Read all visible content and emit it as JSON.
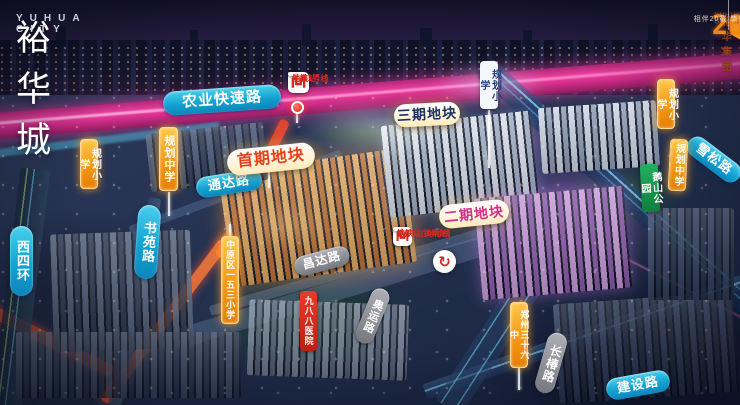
{
  "brand": {
    "name_cn": "裕华城",
    "name_en": "YUHUA CITY"
  },
  "group": {
    "name": "裕华集团",
    "name_en": "YUHUA GROUP",
    "anniversary_number": "20",
    "tagline": "相伴20载 筑就未来"
  },
  "metro": {
    "lanzhai": {
      "line1": "地铁1号线",
      "line2": "兰寨站"
    },
    "tielu": {
      "line1": "地铁1、14号线",
      "line2": "铁炉站(换乘站)"
    },
    "interchange_icon": "↻"
  },
  "map": {
    "labels": [
      {
        "name": "road-label-nongye-expressway",
        "cls": "lbl pill cyan",
        "text": "农业快速路",
        "x": 163,
        "y": 88,
        "w": 118,
        "h": 24,
        "rot": -4,
        "fs": 15
      },
      {
        "name": "road-label-tongda",
        "cls": "lbl pill cyan",
        "text": "通达路",
        "x": 196,
        "y": 173,
        "w": 66,
        "h": 21,
        "rot": -9,
        "fs": 13
      },
      {
        "name": "road-label-shuyuan",
        "cls": "lbl pill cyan v",
        "text": "书苑路",
        "x": 136,
        "y": 205,
        "w": 23,
        "h": 74,
        "rot": 4,
        "fs": 13
      },
      {
        "name": "road-label-xisihuan",
        "cls": "lbl pill cyan v",
        "text": "西四环",
        "x": 10,
        "y": 226,
        "w": 23,
        "h": 70,
        "rot": 0,
        "fs": 13
      },
      {
        "name": "road-label-xuesong",
        "cls": "lbl pill cyan",
        "text": "雪松路",
        "x": 683,
        "y": 149,
        "w": 62,
        "h": 21,
        "rot": 37,
        "fs": 13
      },
      {
        "name": "road-label-jianshe",
        "cls": "lbl pill cyan",
        "text": "建设路",
        "x": 606,
        "y": 374,
        "w": 64,
        "h": 22,
        "rot": -10,
        "fs": 13
      },
      {
        "name": "road-label-changda",
        "cls": "lbl pill gray",
        "text": "昌达路",
        "x": 294,
        "y": 251,
        "w": 56,
        "h": 20,
        "rot": -15,
        "fs": 12
      },
      {
        "name": "road-label-aoyun",
        "cls": "lbl pill gray v",
        "text": "奥运路",
        "x": 363,
        "y": 287,
        "w": 19,
        "h": 58,
        "rot": 22,
        "fs": 11
      },
      {
        "name": "road-label-changchun",
        "cls": "lbl pill gray v",
        "text": "长椿路",
        "x": 541,
        "y": 332,
        "w": 20,
        "h": 62,
        "rot": 16,
        "fs": 12
      },
      {
        "name": "place-label-988-hospital",
        "cls": "lbl tag red v",
        "text": "九八八医院",
        "x": 300,
        "y": 291,
        "w": 17,
        "h": 60,
        "rot": 0,
        "fs": 9
      },
      {
        "name": "place-label-planned-primary-west",
        "cls": "lbl tag orange v",
        "text": "规划小学",
        "x": 80,
        "y": 139,
        "w": 18,
        "h": 50,
        "rot": 0,
        "fs": 10
      },
      {
        "name": "place-label-planned-middle-west",
        "cls": "lbl tag orange v",
        "text": "规划中学",
        "x": 159,
        "y": 127,
        "w": 19,
        "h": 64,
        "rot": 0,
        "fs": 11
      },
      {
        "name": "place-label-153-primary",
        "cls": "lbl tag orange v",
        "text": "中原区一五三小学",
        "x": 221,
        "y": 236,
        "w": 18,
        "h": 88,
        "rot": 0,
        "fs": 9
      },
      {
        "name": "place-label-zhengzhou-36-middle",
        "cls": "lbl tag orange v",
        "text": "郑州三十六中",
        "x": 510,
        "y": 302,
        "w": 18,
        "h": 66,
        "rot": 0,
        "fs": 9
      },
      {
        "name": "place-label-planned-primary-east",
        "cls": "lbl tag orange v",
        "text": "规划小学",
        "x": 657,
        "y": 79,
        "w": 18,
        "h": 50,
        "rot": 0,
        "fs": 10
      },
      {
        "name": "place-label-planned-middle-east",
        "cls": "lbl tag orange v",
        "text": "规划中学",
        "x": 669,
        "y": 139,
        "w": 18,
        "h": 52,
        "rot": 3,
        "fs": 10
      },
      {
        "name": "place-label-eshan-park",
        "cls": "lbl tag green v",
        "text": "鹅山公园",
        "x": 641,
        "y": 164,
        "w": 18,
        "h": 48,
        "rot": -3,
        "fs": 10
      },
      {
        "name": "place-label-planned-primary-white",
        "cls": "lbl tag white v",
        "text": "规划小学",
        "x": 480,
        "y": 61,
        "w": 18,
        "h": 48,
        "rot": 0,
        "fs": 10
      },
      {
        "name": "phase-label-first",
        "cls": "lbl pill phase phase1",
        "text": "首期地块",
        "x": 227,
        "y": 146,
        "w": 88,
        "h": 26,
        "rot": -6,
        "fs": 16
      },
      {
        "name": "phase-label-third",
        "cls": "lbl pill phase phase3",
        "text": "三期地块",
        "x": 394,
        "y": 103,
        "w": 66,
        "h": 23,
        "rot": -3,
        "fs": 14
      },
      {
        "name": "phase-label-second",
        "cls": "lbl pill phase phase2",
        "text": "二期地块",
        "x": 439,
        "y": 202,
        "w": 70,
        "h": 24,
        "rot": -6,
        "fs": 14
      }
    ],
    "stems": [
      {
        "x": 168,
        "y": 192,
        "h": 24
      },
      {
        "x": 229,
        "y": 224,
        "h": 12
      },
      {
        "x": 518,
        "y": 368,
        "h": 22
      },
      {
        "x": 488,
        "y": 110,
        "h": 58
      },
      {
        "x": 268,
        "y": 172,
        "h": 16
      },
      {
        "x": 296,
        "y": 114,
        "h": 9
      }
    ]
  },
  "colors": {
    "road_cyan": "#13a2d2",
    "road_gray": "#77777f",
    "school_orange": "#f39410",
    "hospital_red": "#d6281e",
    "park_green": "#0e7e3e",
    "expressway_magenta": "#d62e8c",
    "phase1_text": "#e8401c",
    "phase2_text": "#d62d8a",
    "phase3_text": "#1d3160"
  }
}
